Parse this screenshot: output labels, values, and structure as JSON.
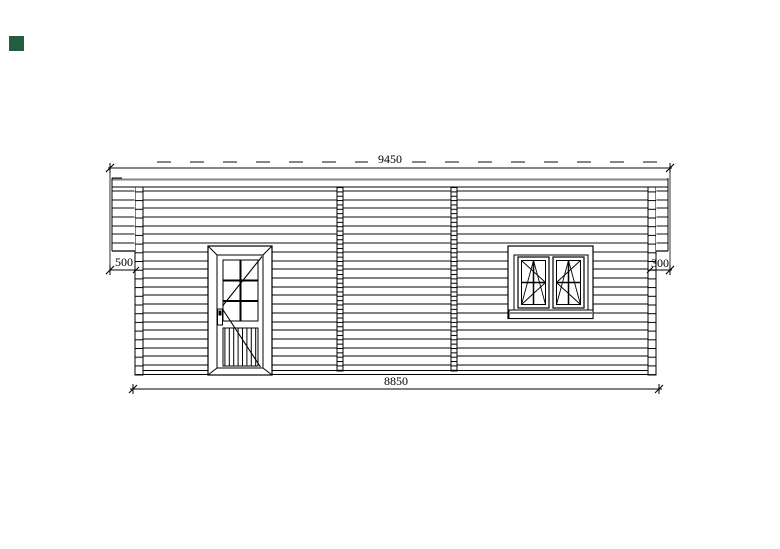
{
  "title": "house-side-elevation-drawing",
  "marker": {
    "color": "#245c3e"
  },
  "dimensions": {
    "roof_length": "9450",
    "wall_length": "8850",
    "left_overhang": "500",
    "right_overhang": "300"
  },
  "colors": {
    "background": "#ffffff",
    "log_line_gray": "#858585",
    "line_black": "#000000"
  }
}
